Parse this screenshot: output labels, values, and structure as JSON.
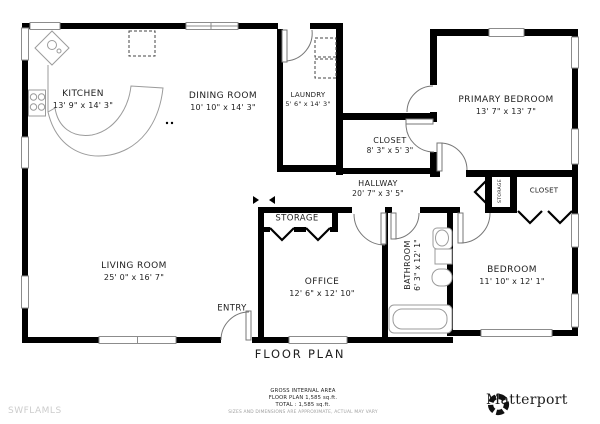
{
  "plan": {
    "title": "FLOOR PLAN",
    "rooms": {
      "kitchen": {
        "name": "KITCHEN",
        "dims": "13' 9\" x 14' 3\""
      },
      "dining_room": {
        "name": "DINING ROOM",
        "dims": "10' 10\" x 14' 3\""
      },
      "laundry": {
        "name": "LAUNDRY",
        "dims": "5' 6\" x 14' 3\""
      },
      "primary_bedroom": {
        "name": "PRIMARY BEDROOM",
        "dims": "13' 7\" x 13' 7\""
      },
      "closet": {
        "name": "CLOSET",
        "dims": "8' 3\" x 5' 3\""
      },
      "hallway": {
        "name": "HALLWAY",
        "dims": "20' 7\" x 3' 5\""
      },
      "living_room": {
        "name": "LIVING ROOM",
        "dims": "25' 0\" x 16' 7\""
      },
      "office": {
        "name": "OFFICE",
        "dims": "12' 6\" x 12' 10\""
      },
      "bathroom": {
        "name": "BATHROOM",
        "dims": "6' 3\" x 12' 1\""
      },
      "bedroom": {
        "name": "BEDROOM",
        "dims": "11' 10\" x 12' 1\""
      },
      "storage_room": {
        "name": "STORAGE"
      },
      "storage_closet": {
        "name": "STORAGE"
      },
      "bedroom_closet": {
        "name": "CLOSET"
      },
      "entry": {
        "name": "ENTRY"
      }
    },
    "area_summary": {
      "heading": "GROSS INTERNAL AREA",
      "floor_line": "FLOOR PLAN 1,585 sq.ft.",
      "total_line": "TOTAL :  1,585 sq.ft.",
      "disclaimer": "SIZES AND DIMENSIONS ARE APPROXIMATE, ACTUAL MAY VARY"
    }
  },
  "branding": {
    "watermark": "SWFLAMLS",
    "logo_text": "Matterport"
  },
  "colors": {
    "wall": "#000000",
    "fixture_outline": "#9b9b9b",
    "label_text": "#1e1e1e",
    "watermark_text": "#cccccc"
  }
}
